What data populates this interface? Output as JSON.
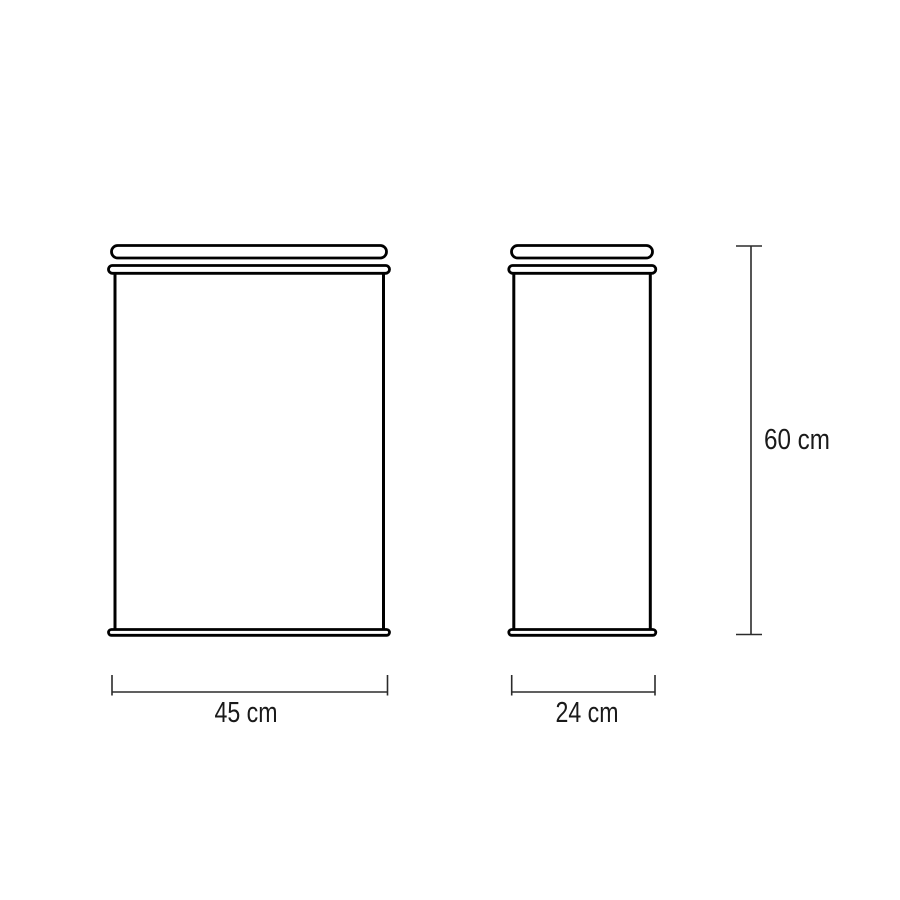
{
  "colors": {
    "background": "#ffffff",
    "object_outline": "#000000",
    "dimension_line": "#2b2b2b",
    "label_text": "#1a1a1a"
  },
  "diagram": {
    "kind": "product-dimension-drawing",
    "views": [
      {
        "id": "front",
        "shown_width_label": "45 cm"
      },
      {
        "id": "side",
        "shown_width_label": "24 cm"
      }
    ],
    "dimensions": {
      "width": {
        "label": "45 cm",
        "value": 45,
        "unit": "cm"
      },
      "depth": {
        "label": "24 cm",
        "value": 24,
        "unit": "cm"
      },
      "height": {
        "label": "60 cm",
        "value": 60,
        "unit": "cm"
      }
    }
  }
}
